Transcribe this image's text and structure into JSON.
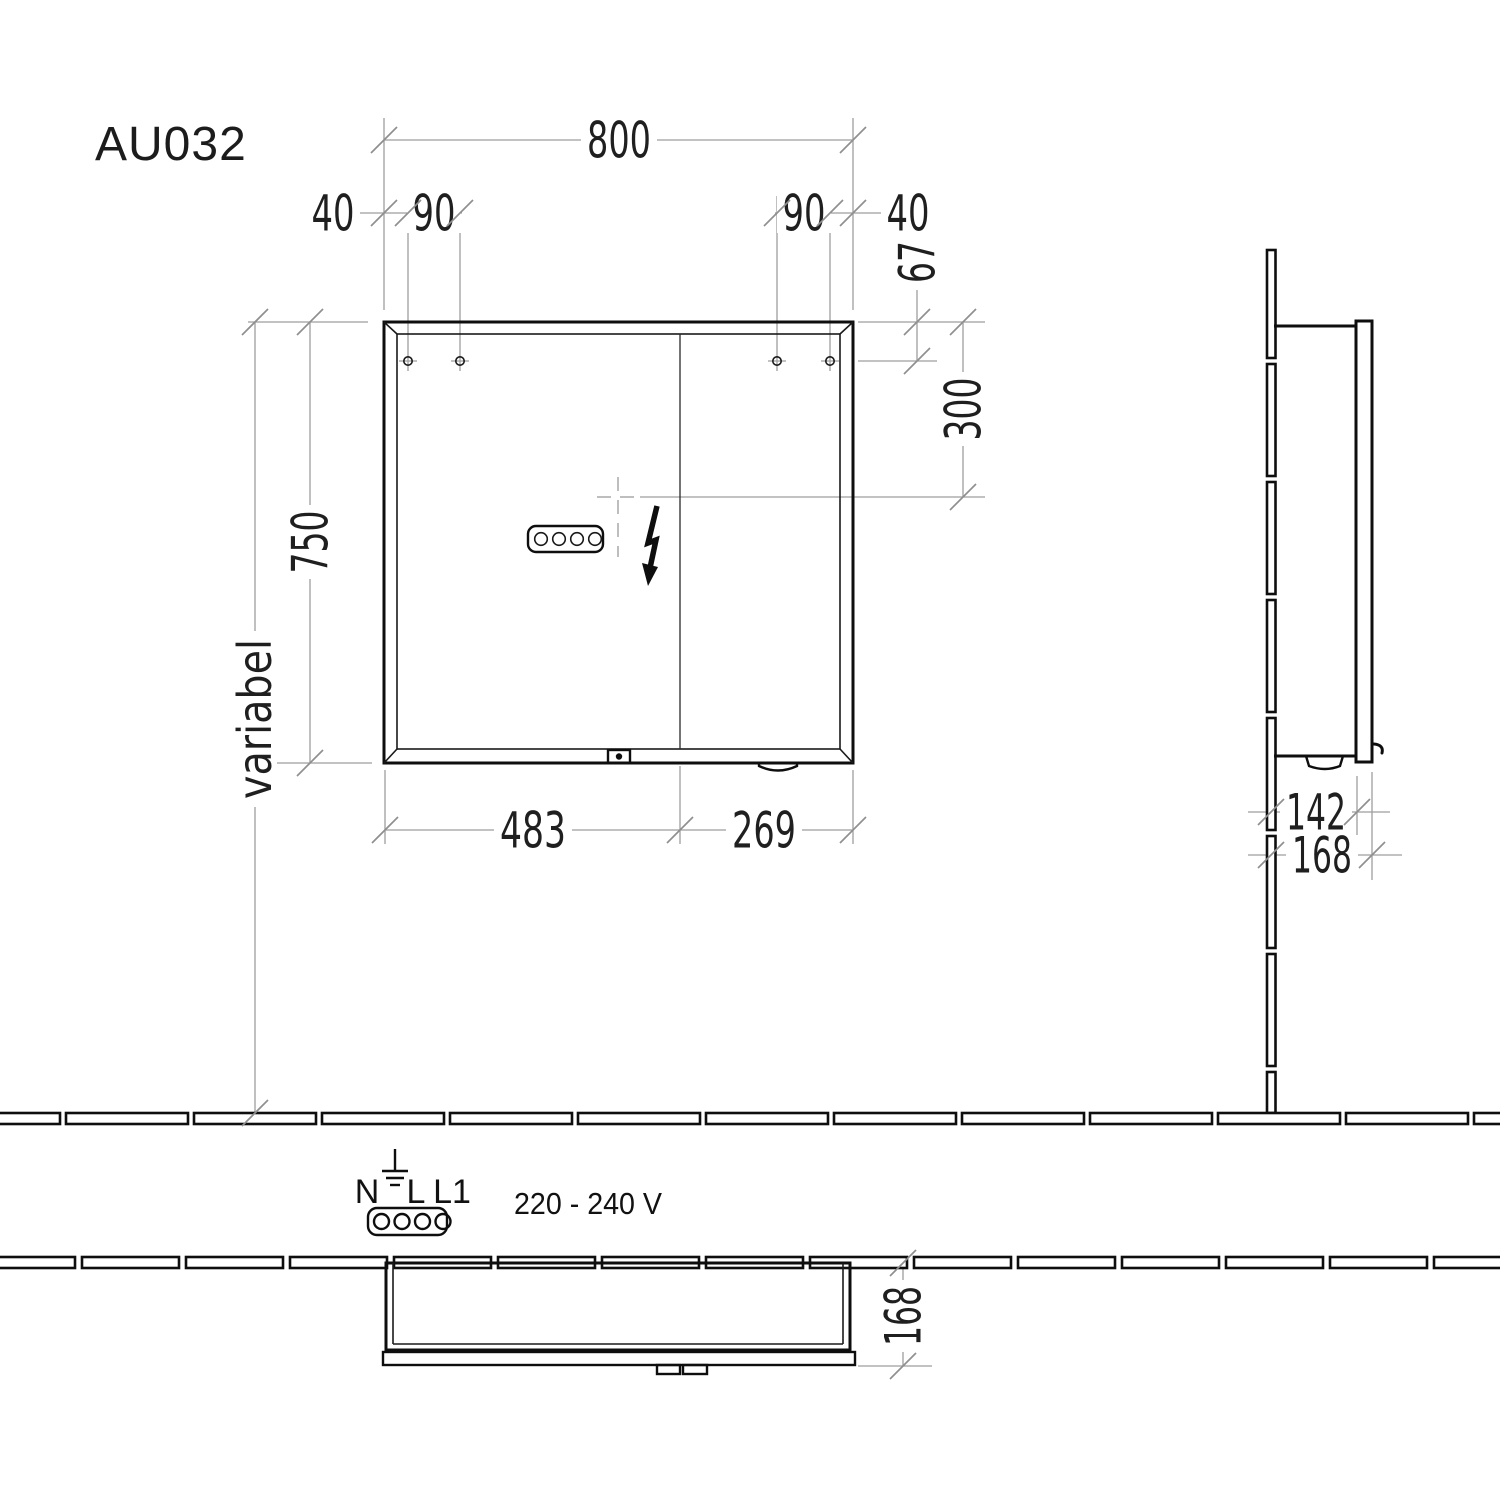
{
  "title": "AU032",
  "colors": {
    "object_line": "#0e0e0e",
    "dimension_line": "#9e9e9e",
    "dimension_text": "#1f1f1f",
    "background": "#ffffff"
  },
  "front_view": {
    "width_total": "800",
    "hole_offset_left": "40",
    "hole_pitch_left": "90",
    "hole_pitch_right": "90",
    "hole_offset_right": "40",
    "holes_from_top": "67",
    "outlet_from_top": "300",
    "height_total": "750",
    "mounting_height": "variabel",
    "door_left_width": "483",
    "door_right_width": "269"
  },
  "side_view": {
    "body_depth": "142",
    "total_depth": "168"
  },
  "top_view": {
    "total_depth": "168"
  },
  "electrical": {
    "terminal_n": "N",
    "terminal_l": "L",
    "terminal_l1": "L1",
    "voltage_range": "220 - 240 V"
  },
  "icons": {
    "lightning": "lightning-bolt-icon",
    "earth": "earth-ground-icon",
    "connector": "power-connector-icon",
    "crosshair": "center-crosshair-icon"
  }
}
